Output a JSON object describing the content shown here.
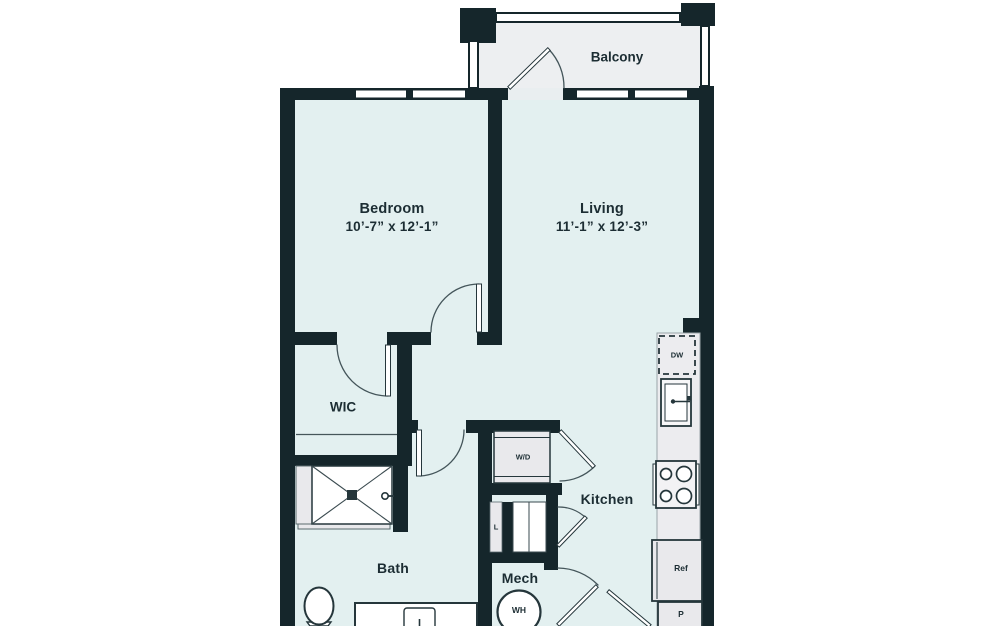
{
  "rooms": {
    "balcony": {
      "label": "Balcony"
    },
    "bedroom": {
      "label": "Bedroom",
      "dimensions": "10’-7” x 12’-1”"
    },
    "living": {
      "label": "Living",
      "dimensions": "11’-1” x 12’-3”"
    },
    "wic": {
      "label": "WIC"
    },
    "bath": {
      "label": "Bath"
    },
    "kitchen": {
      "label": "Kitchen"
    },
    "mech": {
      "label": "Mech"
    }
  },
  "fixtures": {
    "washer_dryer": "W/D",
    "dishwasher": "DW",
    "linen_closet": "L",
    "refrigerator": "Ref",
    "pantry": "P",
    "water_heater": "WH"
  },
  "colors": {
    "wall": "#15262b",
    "unit_floor": "#e3f0f0",
    "balcony_floor": "#edeff1",
    "fixture_gray": "#e9e9ec",
    "text": "#1c2d33"
  }
}
